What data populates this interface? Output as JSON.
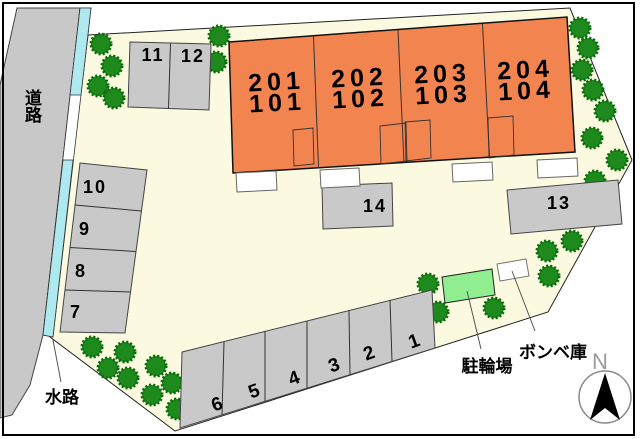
{
  "colors": {
    "site": "#FBFAE0",
    "road": "#C8C8C8",
    "parking": "#C9C9C9",
    "building": "#F28450",
    "water": "#AEE9F0",
    "tree": "#1E8A1E",
    "tree_edge": "#0B6B0B",
    "bike": "#90EE90",
    "white": "#FFFFFF"
  },
  "labels": {
    "road": "道路",
    "waterway": "水路",
    "bike": "駐輪場",
    "bombe": "ボンベ庫",
    "north": "N"
  },
  "building_units": [
    {
      "upper": "201",
      "lower": "101"
    },
    {
      "upper": "202",
      "lower": "102"
    },
    {
      "upper": "203",
      "lower": "103"
    },
    {
      "upper": "204",
      "lower": "104"
    }
  ],
  "parking": {
    "bottom_row": [
      "6",
      "5",
      "4",
      "3",
      "2",
      "1"
    ],
    "left_column": [
      "10",
      "9",
      "8",
      "7"
    ],
    "top_block": [
      "11",
      "12"
    ],
    "stall13": "13",
    "stall14": "14"
  }
}
